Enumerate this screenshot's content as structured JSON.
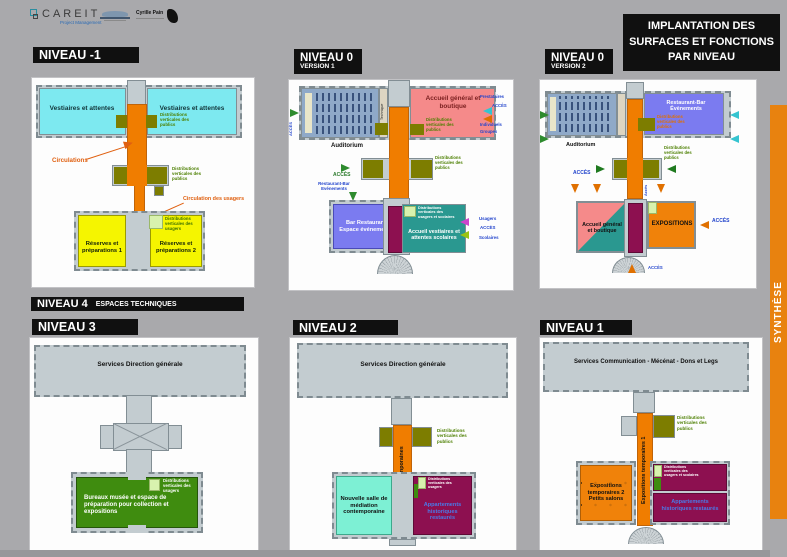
{
  "page": {
    "number": "24"
  },
  "header": {
    "careit_name": "CAREIT",
    "careit_tagline": "Project Management",
    "partner_logo": "Cyrille Pain",
    "title": "IMPLANTATION DES SURFACES ET FONCTIONS PAR NIVEAU"
  },
  "sidebar": {
    "label": "SYNTHÈSE"
  },
  "shared": {
    "dvp": "Distributions verticales des publics",
    "dvu": "Distributions verticales des usagers",
    "dvus": "Distributions verticales des usagers et scolaires",
    "acces": "ACCÈS",
    "auditorium": "Auditorium"
  },
  "nm1": {
    "title": "NIVEAU -1",
    "vestiaires": "Vestiaires et attentes",
    "circulations": "Circulations",
    "circulation_usagers": "Circulation des usagers",
    "reserves1": "Réserves et préparations 1",
    "reserves2": "Réserves et préparations 2"
  },
  "n0v1": {
    "title": "NIVEAU 0",
    "version": "VERSION 1",
    "technique": "Technique",
    "accueil_boutique": "Accueil général et boutique",
    "prestataires": "Prestataires",
    "individuels": "Individuels",
    "groupes": "Groupes",
    "restaurant_bar": "Restaurant-Bar Evénements",
    "bar_restaurant": "Bar Restaurant Espace événements",
    "accueil_vestiaires": "Accueil vestiaires et attentes scolaires",
    "usagers": "Usagers",
    "scolaires": "Scolaires"
  },
  "n0v2": {
    "title": "NIVEAU 0",
    "version": "VERSION 2",
    "restaurant_bar": "Restaurant-Bar Évènements",
    "acces_vertical": "Accès",
    "accueil_boutique": "Accueil général et boutique",
    "expositions": "EXPOSITIONS"
  },
  "n4": {
    "title": "NIVEAU 4",
    "subtitle": "ESPACES TECHNIQUES"
  },
  "n3": {
    "title": "NIVEAU 3",
    "services": "Services Direction générale",
    "bureaux": "Bureaux musée et espace de préparation pour collection et expositions"
  },
  "n2": {
    "title": "NIVEAU 2",
    "services": "Services Direction générale",
    "expositions_verticales": "Expositions contemporaines",
    "mediation": "Nouvelle salle de médiation contemporaine",
    "appartements": "Appartements historiques restaurés"
  },
  "n1": {
    "title": "NIVEAU 1",
    "services": "Services Communication - Mécénat - Dons et Legs",
    "expositions_verticales": "Expositions temporaires 1",
    "expositions2": "Expositions temporaires 2 Petits salons",
    "appartements": "Appartements historiques restaurés"
  },
  "colors": {
    "sidebar_orange": "#E8820F",
    "circulation_orange": "#F07D00",
    "vestiaires_cyan": "#7DE9F0",
    "reserves_yellow": "#F5F500",
    "olive": "#7D7D00",
    "salmon": "#F58A8A",
    "purple_blue": "#7B7BF0",
    "teal": "#2A9890",
    "maroon": "#8D1050",
    "green_bureaux": "#3F8C0F",
    "aqua": "#7DF0D4",
    "expo_orange": "#F0820A",
    "light_green": "#D8F2AE"
  }
}
